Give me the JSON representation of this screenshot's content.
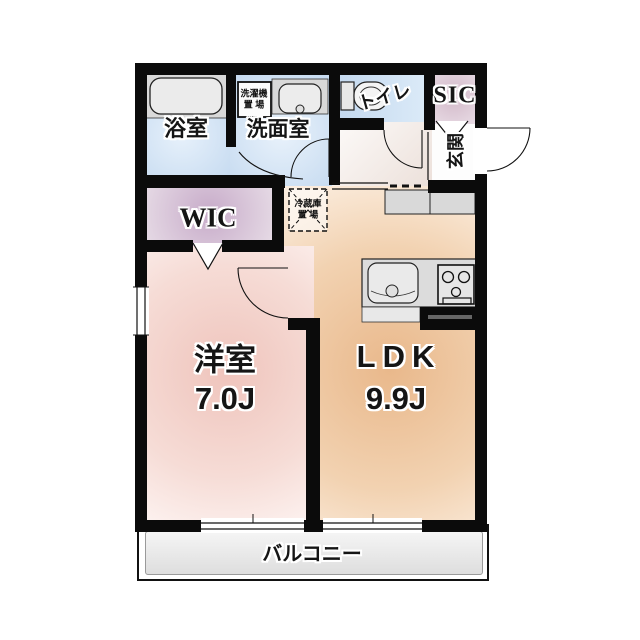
{
  "floorplan": {
    "rooms": {
      "bath": {
        "label": "浴室"
      },
      "washroom": {
        "label": "洗面室"
      },
      "toilet": {
        "label": "トイレ"
      },
      "sic": {
        "label": "SIC"
      },
      "entrance": {
        "label": "玄関"
      },
      "wic": {
        "label": "WIC"
      },
      "western": {
        "label": "洋室",
        "area": "7.0J"
      },
      "ldk": {
        "label": "LDK",
        "area": "9.9J"
      },
      "balcony": {
        "label": "バルコニー"
      }
    },
    "annotations": {
      "washer": {
        "line1": "洗濯機",
        "line2": "置 場"
      },
      "fridge": {
        "line1": "冷蔵庫",
        "line2": "置 場"
      }
    },
    "colors": {
      "wall": "#0b0b0b",
      "bath_floor": "#c5daf0",
      "washroom_floor": "#c8dcf1",
      "toilet_floor": "#c3d8ef",
      "sic_floor": "#d2b8c8",
      "wic_floor": "#c7abc9",
      "western_room_floor": "#efc4bc",
      "ldk_floor": "#e9b88b",
      "balcony_floor": "#e7e7e7",
      "fixture": "#dcdcdc"
    }
  }
}
